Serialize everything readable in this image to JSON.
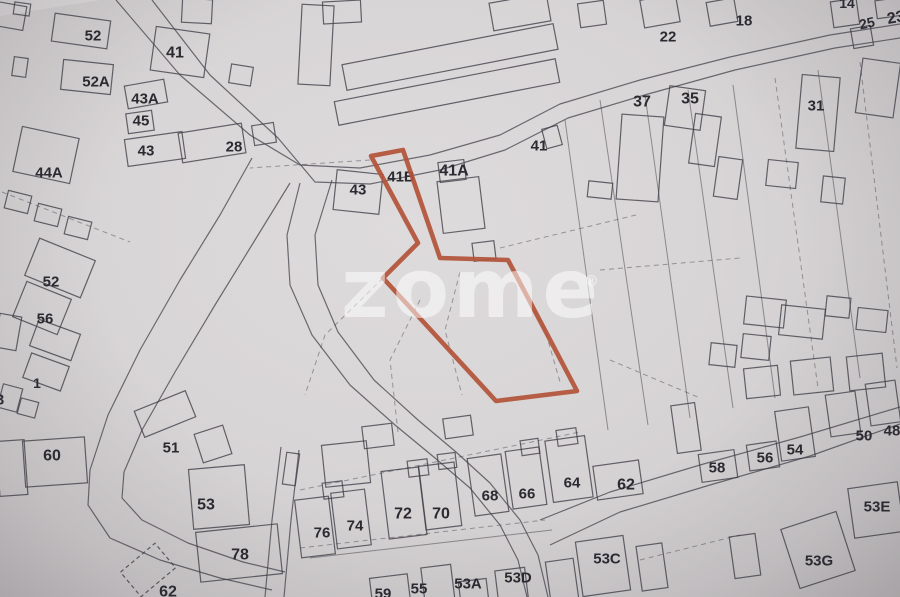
{
  "watermark": {
    "text": "zome",
    "registered": "®"
  },
  "palette": {
    "background": "#d8d5d6",
    "line": "#3e3d46",
    "label": "#2b2a31",
    "highlight": "#b25338",
    "watermark": "rgba(255,255,255,0.52)"
  },
  "map": {
    "width": 900,
    "height": 597,
    "highlight_parcel": {
      "label": "41B",
      "points": "371,156 403,150 440,258 508,260 577,391 496,401 383,278 418,243"
    },
    "watermark_layout": {
      "x": 341,
      "y": 317,
      "size": 82,
      "letter_spacing": 4,
      "reg_x": 584,
      "reg_y": 286,
      "reg_size": 15
    },
    "roads": [
      {
        "name": "main-road-upper-edge",
        "d": "M116,0 L180,75 L250,135 L300,165 L360,168 L430,155 L500,135 L560,104 L640,80 L730,57 L830,35 L900,24"
      },
      {
        "name": "main-road-lower-edge",
        "d": "M152,0 L210,75 L278,138 L315,182 L370,184 L440,170 L505,150 L568,118 L648,94 L735,70 L835,48 L900,38"
      },
      {
        "name": "west-road-west-edge",
        "d": "M252,158 L220,215 L180,280 L140,350 L108,415 L90,470 L88,505 L110,538 L160,560 L220,578 L272,590"
      },
      {
        "name": "west-road-east-edge",
        "d": "M290,183 L255,240 L215,305 L175,372 L142,430 L124,472 L122,498 L142,520 L188,543 L243,562 L285,572"
      },
      {
        "name": "central-road-west-edge",
        "d": "M300,183 L287,235 L290,285 L312,335 L350,385 L395,425 L435,458 L470,488 L500,525 L518,560 L527,597"
      },
      {
        "name": "central-road-east-edge",
        "d": "M332,180 L315,235 L318,285 L338,332 L374,380 L418,420 L456,452 L490,483 L520,520 L538,555 L548,597"
      },
      {
        "name": "south-road-upper-edge",
        "d": "M540,520 L610,492 L700,465 L800,437 L900,407"
      },
      {
        "name": "south-road-lower-edge",
        "d": "M550,545 L620,512 L710,485 L810,456 L900,424"
      },
      {
        "name": "lane-west-edge",
        "d": "M281,447 L272,520 L265,597"
      },
      {
        "name": "lane-east-edge",
        "d": "M299,450 L291,520 L284,597"
      }
    ],
    "parcel_lines": [
      {
        "d": "M370,160 L250,168",
        "dashed": true
      },
      {
        "d": "M383,278 L325,335 L305,395",
        "dashed": true
      },
      {
        "d": "M420,300 L390,360 L398,432",
        "dashed": true
      },
      {
        "d": "M460,272 L445,330 L462,395",
        "dashed": true
      },
      {
        "d": "M508,262 L545,330 L560,382",
        "dashed": true
      },
      {
        "d": "M500,248 L640,214",
        "dashed": true
      },
      {
        "d": "M565,120 L608,430",
        "dashed": false
      },
      {
        "d": "M600,100 L648,425",
        "dashed": false
      },
      {
        "d": "M645,95 L690,418",
        "dashed": false
      },
      {
        "d": "M688,90 L733,408",
        "dashed": false
      },
      {
        "d": "M733,85 L775,398",
        "dashed": false
      },
      {
        "d": "M775,78 L818,388",
        "dashed": true
      },
      {
        "d": "M818,70 L860,378",
        "dashed": false
      },
      {
        "d": "M860,62 L897,368",
        "dashed": true
      },
      {
        "d": "M600,270 L740,258",
        "dashed": true
      },
      {
        "d": "M610,360 L700,398",
        "dashed": true
      },
      {
        "d": "M2,192 L130,242",
        "dashed": true
      },
      {
        "d": "M300,548 L545,520",
        "dashed": true
      },
      {
        "d": "M310,558 L552,530",
        "dashed": false
      },
      {
        "d": "M300,490 L580,432",
        "dashed": true
      },
      {
        "d": "M640,560 L740,535",
        "dashed": true
      }
    ],
    "buildings_format": "x,y,w,h,rot,dashed",
    "buildings": [
      [
        10,
        16,
        30,
        24,
        10,
        0
      ],
      [
        22,
        9,
        16,
        12,
        8,
        0
      ],
      [
        81,
        31,
        56,
        28,
        8,
        0
      ],
      [
        180,
        52,
        54,
        44,
        8,
        0
      ],
      [
        87,
        77,
        50,
        30,
        6,
        0
      ],
      [
        20,
        67,
        14,
        19,
        8,
        0
      ],
      [
        146,
        94,
        40,
        23,
        -10,
        0
      ],
      [
        140,
        122,
        26,
        20,
        -8,
        0
      ],
      [
        155,
        149,
        58,
        27,
        -8,
        0
      ],
      [
        212,
        143,
        64,
        30,
        -9,
        0
      ],
      [
        264,
        134,
        22,
        20,
        -9,
        0
      ],
      [
        46,
        155,
        58,
        46,
        12,
        0
      ],
      [
        197,
        11,
        30,
        24,
        3,
        0
      ],
      [
        241,
        75,
        22,
        19,
        9,
        0
      ],
      [
        316,
        45,
        32,
        80,
        3,
        0
      ],
      [
        342,
        12,
        38,
        22,
        -3,
        0
      ],
      [
        450,
        57,
        215,
        26,
        -11,
        0
      ],
      [
        447,
        92,
        225,
        24,
        -11,
        0
      ],
      [
        520,
        12,
        58,
        28,
        -10,
        0
      ],
      [
        592,
        14,
        26,
        24,
        -8,
        0
      ],
      [
        660,
        11,
        36,
        28,
        -10,
        0
      ],
      [
        722,
        12,
        28,
        24,
        -10,
        0
      ],
      [
        845,
        13,
        26,
        26,
        -8,
        0
      ],
      [
        862,
        37,
        20,
        20,
        -10,
        0
      ],
      [
        889,
        8,
        26,
        18,
        -8,
        0
      ],
      [
        640,
        158,
        42,
        85,
        4,
        0
      ],
      [
        685,
        108,
        36,
        40,
        8,
        0
      ],
      [
        600,
        190,
        24,
        16,
        6,
        0
      ],
      [
        705,
        140,
        26,
        50,
        8,
        0
      ],
      [
        728,
        178,
        24,
        40,
        8,
        0
      ],
      [
        818,
        113,
        38,
        74,
        5,
        0
      ],
      [
        878,
        88,
        38,
        55,
        8,
        0
      ],
      [
        782,
        174,
        30,
        26,
        6,
        0
      ],
      [
        833,
        190,
        22,
        26,
        6,
        0
      ],
      [
        358,
        192,
        46,
        40,
        6,
        0
      ],
      [
        461,
        205,
        42,
        52,
        -7,
        0
      ],
      [
        452,
        171,
        26,
        20,
        -7,
        0
      ],
      [
        484,
        251,
        22,
        18,
        -7,
        0
      ],
      [
        552,
        137,
        16,
        20,
        -15,
        0
      ],
      [
        765,
        312,
        40,
        28,
        6,
        0
      ],
      [
        802,
        322,
        44,
        30,
        6,
        0
      ],
      [
        838,
        307,
        24,
        20,
        6,
        0
      ],
      [
        872,
        320,
        30,
        22,
        6,
        0
      ],
      [
        756,
        347,
        28,
        24,
        6,
        0
      ],
      [
        723,
        355,
        26,
        22,
        6,
        0
      ],
      [
        762,
        382,
        34,
        30,
        -6,
        0
      ],
      [
        812,
        376,
        40,
        34,
        -6,
        0
      ],
      [
        866,
        372,
        36,
        34,
        -6,
        0
      ],
      [
        60,
        268,
        60,
        40,
        22,
        0
      ],
      [
        42,
        308,
        48,
        38,
        22,
        0
      ],
      [
        55,
        340,
        44,
        28,
        20,
        0
      ],
      [
        46,
        372,
        40,
        26,
        20,
        0
      ],
      [
        8,
        332,
        22,
        34,
        10,
        0
      ],
      [
        10,
        398,
        20,
        24,
        15,
        0
      ],
      [
        28,
        408,
        18,
        16,
        15,
        0
      ],
      [
        18,
        202,
        24,
        18,
        14,
        0
      ],
      [
        48,
        215,
        24,
        18,
        14,
        0
      ],
      [
        78,
        228,
        24,
        18,
        14,
        0
      ],
      [
        55,
        462,
        62,
        46,
        -4,
        0
      ],
      [
        12,
        468,
        28,
        55,
        -4,
        0
      ],
      [
        165,
        414,
        55,
        28,
        -22,
        0
      ],
      [
        213,
        444,
        30,
        30,
        -18,
        0
      ],
      [
        219,
        497,
        56,
        60,
        -5,
        0
      ],
      [
        239,
        553,
        82,
        50,
        -6,
        0
      ],
      [
        291,
        469,
        13,
        32,
        8,
        0
      ],
      [
        346,
        464,
        45,
        42,
        -6,
        0
      ],
      [
        148,
        570,
        45,
        32,
        -40,
        1
      ],
      [
        315,
        527,
        34,
        58,
        -7,
        0
      ],
      [
        351,
        519,
        34,
        56,
        -7,
        0
      ],
      [
        404,
        503,
        38,
        68,
        -7,
        0
      ],
      [
        440,
        496,
        36,
        64,
        -7,
        0
      ],
      [
        488,
        485,
        34,
        58,
        -8,
        0
      ],
      [
        526,
        478,
        34,
        58,
        -8,
        0
      ],
      [
        569,
        469,
        40,
        62,
        -8,
        0
      ],
      [
        333,
        490,
        20,
        16,
        -7,
        0
      ],
      [
        418,
        468,
        20,
        16,
        -7,
        0
      ],
      [
        447,
        461,
        18,
        15,
        -7,
        0
      ],
      [
        530,
        447,
        18,
        15,
        -8,
        0
      ],
      [
        567,
        437,
        20,
        16,
        -8,
        0
      ],
      [
        378,
        436,
        30,
        22,
        -7,
        0
      ],
      [
        458,
        427,
        28,
        20,
        -8,
        0
      ],
      [
        390,
        590,
        38,
        28,
        -7,
        0
      ],
      [
        438,
        585,
        30,
        38,
        -7,
        0
      ],
      [
        474,
        595,
        28,
        30,
        -7,
        0
      ],
      [
        512,
        588,
        30,
        38,
        -7,
        0
      ],
      [
        562,
        580,
        28,
        40,
        -8,
        0
      ],
      [
        603,
        566,
        48,
        55,
        -8,
        0
      ],
      [
        652,
        567,
        26,
        45,
        -8,
        0
      ],
      [
        745,
        556,
        26,
        42,
        -8,
        0
      ],
      [
        818,
        550,
        58,
        62,
        -18,
        0
      ],
      [
        876,
        510,
        50,
        50,
        -8,
        0
      ],
      [
        618,
        480,
        46,
        34,
        -8,
        0
      ],
      [
        718,
        466,
        36,
        28,
        -8,
        0
      ],
      [
        763,
        456,
        30,
        26,
        -8,
        0
      ],
      [
        795,
        434,
        34,
        50,
        -8,
        0
      ],
      [
        843,
        414,
        30,
        42,
        -8,
        0
      ],
      [
        883,
        403,
        30,
        42,
        -8,
        0
      ],
      [
        686,
        428,
        24,
        48,
        -8,
        0
      ]
    ],
    "labels": [
      {
        "text": "52",
        "x": 93,
        "y": 36,
        "size": 15
      },
      {
        "text": "41",
        "x": 175,
        "y": 53,
        "size": 16
      },
      {
        "text": "52A",
        "x": 96,
        "y": 82,
        "size": 15
      },
      {
        "text": "43A",
        "x": 145,
        "y": 99,
        "size": 15
      },
      {
        "text": "45",
        "x": 141,
        "y": 121,
        "size": 15
      },
      {
        "text": "43",
        "x": 146,
        "y": 151,
        "size": 15
      },
      {
        "text": "28",
        "x": 234,
        "y": 147,
        "size": 15
      },
      {
        "text": "44A",
        "x": 49,
        "y": 173,
        "size": 15
      },
      {
        "text": "52",
        "x": 51,
        "y": 282,
        "size": 15
      },
      {
        "text": "56",
        "x": 45,
        "y": 319,
        "size": 15
      },
      {
        "text": "1",
        "x": 37,
        "y": 383,
        "size": 14
      },
      {
        "text": "3",
        "x": 0,
        "y": 400,
        "size": 15
      },
      {
        "text": "60",
        "x": 52,
        "y": 456,
        "size": 16
      },
      {
        "text": "51",
        "x": 171,
        "y": 448,
        "size": 15
      },
      {
        "text": "53",
        "x": 206,
        "y": 505,
        "size": 16
      },
      {
        "text": "78",
        "x": 240,
        "y": 555,
        "size": 16
      },
      {
        "text": "62",
        "x": 168,
        "y": 592,
        "size": 16
      },
      {
        "text": "76",
        "x": 322,
        "y": 533,
        "size": 15
      },
      {
        "text": "74",
        "x": 355,
        "y": 526,
        "size": 15
      },
      {
        "text": "72",
        "x": 403,
        "y": 514,
        "size": 16
      },
      {
        "text": "70",
        "x": 441,
        "y": 514,
        "size": 16
      },
      {
        "text": "68",
        "x": 490,
        "y": 496,
        "size": 15
      },
      {
        "text": "66",
        "x": 527,
        "y": 494,
        "size": 15
      },
      {
        "text": "64",
        "x": 572,
        "y": 483,
        "size": 15
      },
      {
        "text": "59",
        "x": 383,
        "y": 594,
        "size": 15
      },
      {
        "text": "55",
        "x": 419,
        "y": 589,
        "size": 15
      },
      {
        "text": "53A",
        "x": 468,
        "y": 584,
        "size": 15
      },
      {
        "text": "53D",
        "x": 518,
        "y": 578,
        "size": 15
      },
      {
        "text": "53C",
        "x": 607,
        "y": 559,
        "size": 15
      },
      {
        "text": "62",
        "x": 626,
        "y": 485,
        "size": 16
      },
      {
        "text": "58",
        "x": 717,
        "y": 468,
        "size": 15
      },
      {
        "text": "56",
        "x": 765,
        "y": 458,
        "size": 15
      },
      {
        "text": "54",
        "x": 795,
        "y": 450,
        "size": 15
      },
      {
        "text": "50",
        "x": 864,
        "y": 436,
        "size": 15
      },
      {
        "text": "48",
        "x": 892,
        "y": 431,
        "size": 15
      },
      {
        "text": "53E",
        "x": 877,
        "y": 507,
        "size": 15
      },
      {
        "text": "53G",
        "x": 819,
        "y": 561,
        "size": 15
      },
      {
        "text": "22",
        "x": 668,
        "y": 37,
        "size": 15
      },
      {
        "text": "18",
        "x": 744,
        "y": 21,
        "size": 15
      },
      {
        "text": "14",
        "x": 847,
        "y": 3,
        "size": 14
      },
      {
        "text": "25",
        "x": 867,
        "y": 23,
        "size": 14,
        "rot": -12
      },
      {
        "text": "23",
        "x": 896,
        "y": 18,
        "size": 16,
        "rot": -10
      },
      {
        "text": "37",
        "x": 642,
        "y": 102,
        "size": 16
      },
      {
        "text": "35",
        "x": 690,
        "y": 99,
        "size": 16
      },
      {
        "text": "31",
        "x": 816,
        "y": 106,
        "size": 15
      },
      {
        "text": "41",
        "x": 539,
        "y": 146,
        "size": 15
      },
      {
        "text": "41A",
        "x": 454,
        "y": 171,
        "size": 16
      },
      {
        "text": "43",
        "x": 358,
        "y": 190,
        "size": 15
      },
      {
        "text": "41B",
        "x": 401,
        "y": 177,
        "size": 15
      }
    ]
  }
}
